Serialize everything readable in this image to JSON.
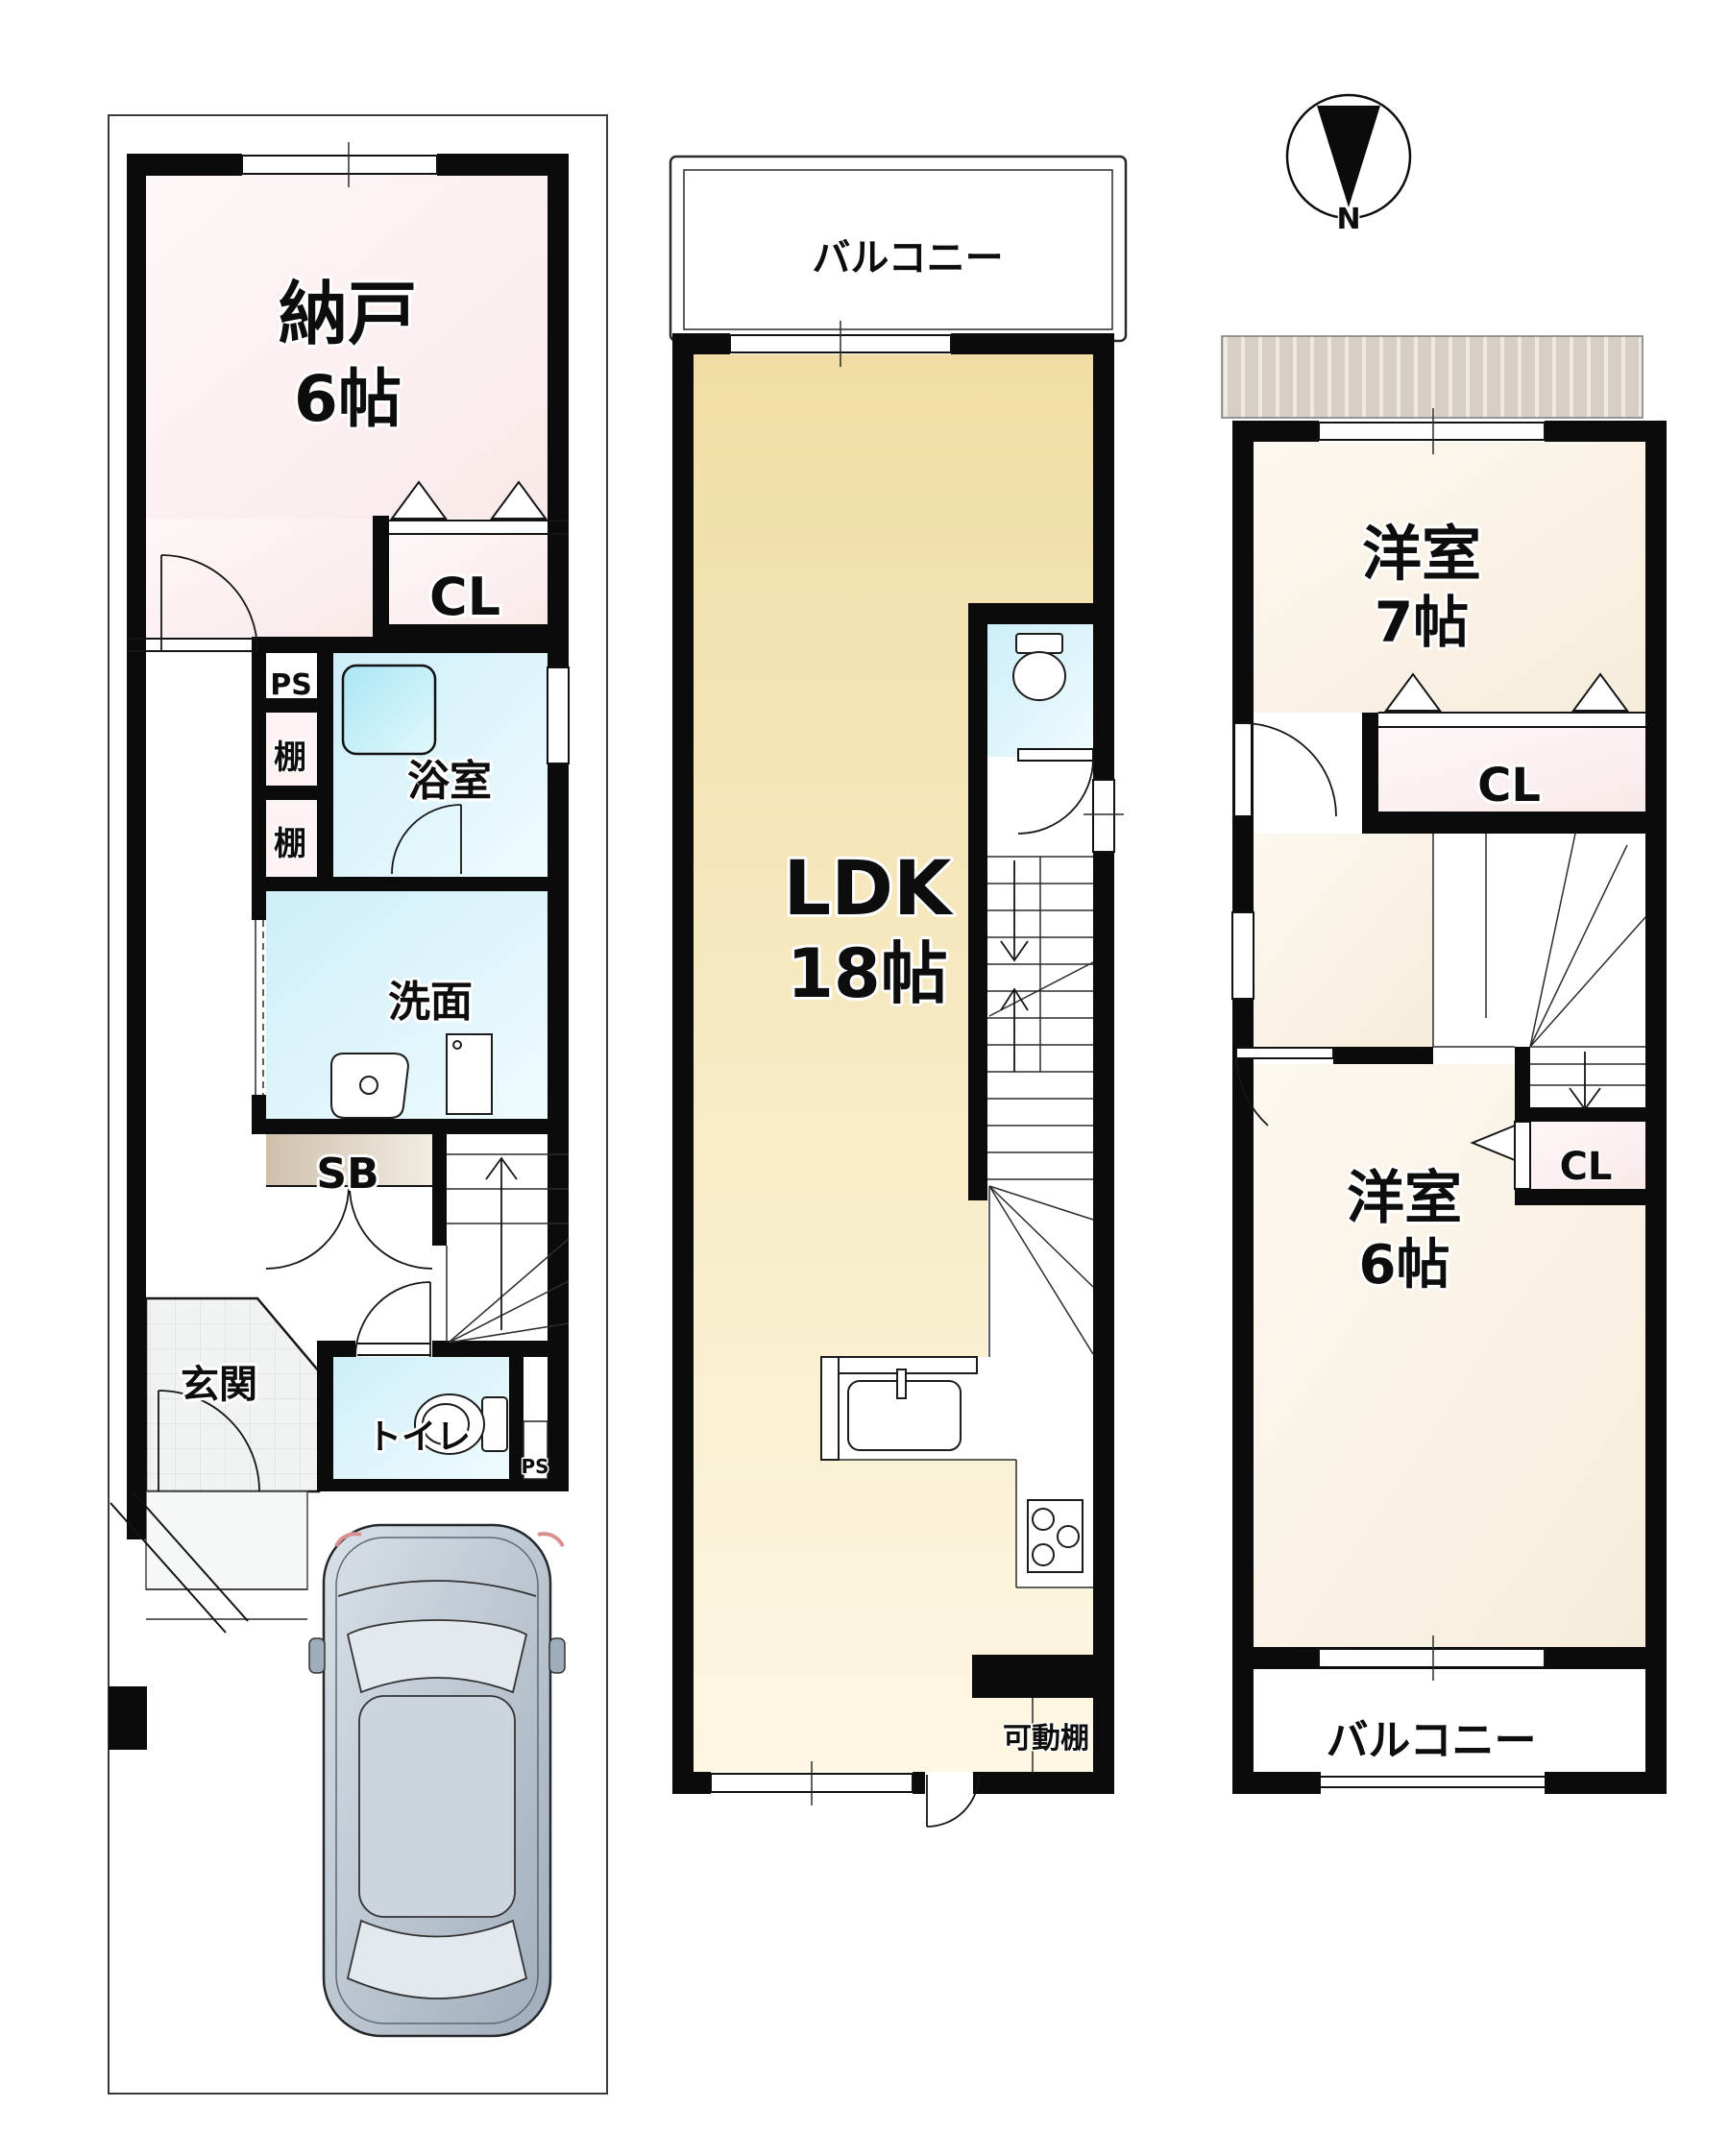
{
  "document_type": "間取り図",
  "compass": {
    "north": "N"
  },
  "f1": {
    "storage_name": "納戸",
    "storage_size": "6帖",
    "closet": "CL",
    "ps_upper": "PS",
    "shelf_a": "棚",
    "shelf_b": "棚",
    "bath": "浴室",
    "washroom": "洗面",
    "shoebox": "SB",
    "entrance": "玄関",
    "toilet": "トイレ",
    "ps_lower": "PS"
  },
  "f2": {
    "balcony": "バルコニー",
    "ldk_name": "LDK",
    "ldk_size": "18帖",
    "movable_shelf": "可動棚"
  },
  "f3": {
    "room7_name": "洋室",
    "room7_size": "7帖",
    "closet_top": "CL",
    "room6_name": "洋室",
    "room6_size": "6帖",
    "closet_bottom": "CL",
    "balcony": "バルコニー"
  },
  "colors": {
    "wall": "#0b0b0b",
    "storage_room_fill": "#fbeeee",
    "wet_area_fill": "#d8f1fa",
    "bathtub_fill": "#b2e8f5",
    "ldk_floor_fill": "#f3e0ab",
    "western_room_fill": "#faf3e6",
    "closet_fill": "#fbecec",
    "shoebox_fill": "#d4c6b4",
    "entrance_tile_fill": "#f1f2f2",
    "roof_hatch_fill": "#d7cfc5",
    "car_body_fill": "#c2cdd8"
  }
}
